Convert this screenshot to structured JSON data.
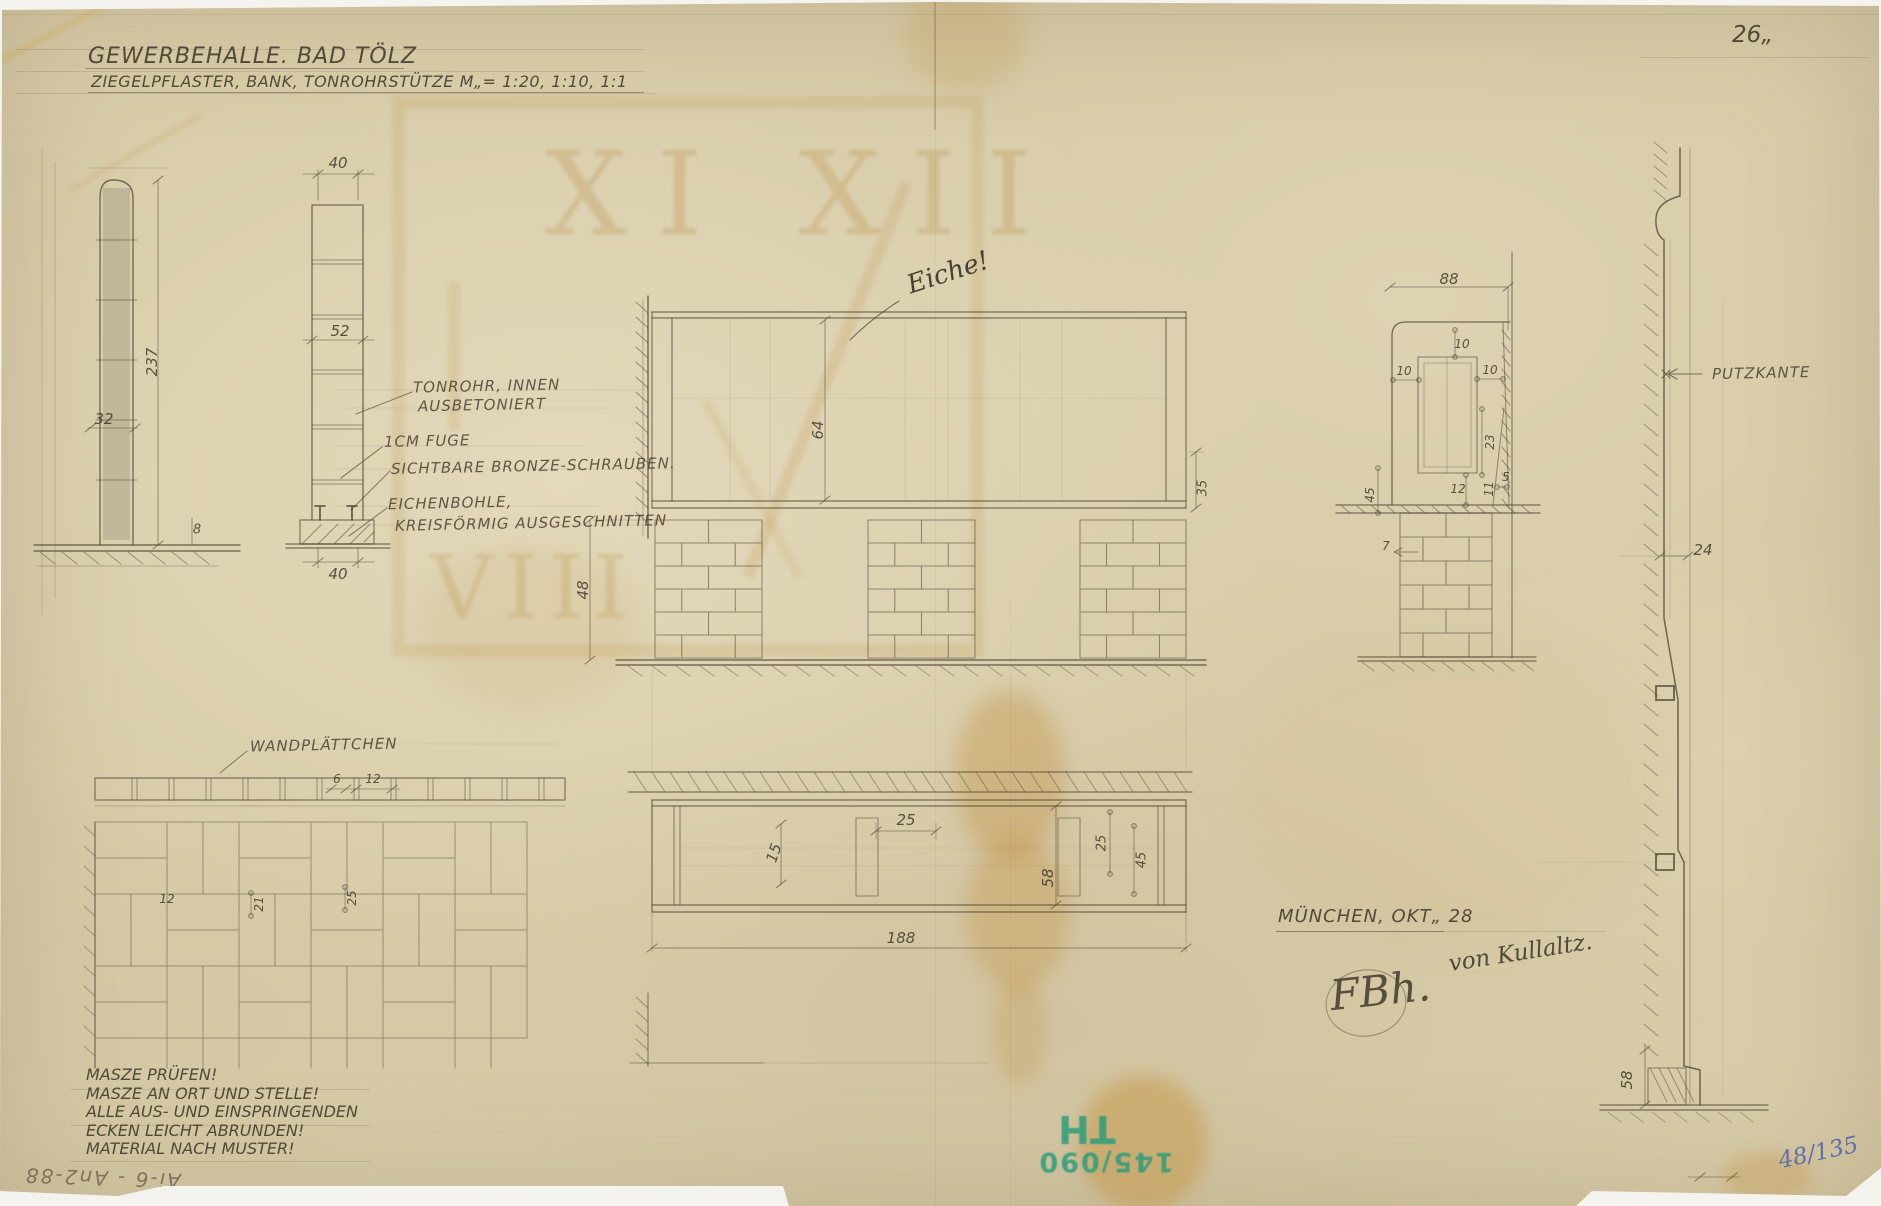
{
  "sheet": {
    "number": "26„",
    "inventory": "48/135",
    "reverse_note": "Ai-6 - An2-88"
  },
  "title": {
    "line1": "GEWERBEHALLE. BAD TÖLZ",
    "line2": "ZIEGELPFLASTER, BANK, TONROHRSTÜTZE M„= 1:20, 1:10, 1:1"
  },
  "notes": {
    "lines": [
      "MASZE PRÜFEN!",
      "MASZE AN ORT UND STELLE!",
      "ALLE AUS- UND EINSPRINGENDEN",
      "ECKEN LEICHT ABRUNDEN!",
      "MATERIAL NACH MUSTER!"
    ]
  },
  "credit": {
    "city_date": "MÜNCHEN, OKT„ 28",
    "signature": "von Kullaltz.",
    "monogram": "FBh.",
    "material_note": "Eiche!"
  },
  "stamp": {
    "letters": "TH",
    "number": "145/090",
    "color": "#2b9d7a"
  },
  "watermark": {
    "numerals_top": "XI XII",
    "numerals_bottom": "VIII"
  },
  "callouts": [
    {
      "text": "TONROHR, INNEN",
      "x": 413,
      "y": 377
    },
    {
      "text": "AUSBETONIERT",
      "x": 418,
      "y": 396
    },
    {
      "text": "1CM FUGE",
      "x": 384,
      "y": 432
    },
    {
      "text": "SICHTBARE BRONZE-SCHRAUBEN.",
      "x": 391,
      "y": 457
    },
    {
      "text": "EICHENBOHLE,",
      "x": 388,
      "y": 494
    },
    {
      "text": "KREISFÖRMIG AUSGESCHNITTEN",
      "x": 395,
      "y": 514
    },
    {
      "text": "WANDPLÄTTCHEN",
      "x": 250,
      "y": 736
    },
    {
      "text": "PUTZKANTE",
      "x": 1712,
      "y": 364
    }
  ],
  "dimensions": [
    {
      "text": "237",
      "x": 152,
      "y": 362,
      "rot": -90
    },
    {
      "text": "32",
      "x": 104,
      "y": 419
    },
    {
      "text": "8",
      "x": 197,
      "y": 530,
      "size": 13
    },
    {
      "text": "40",
      "x": 338,
      "y": 163
    },
    {
      "text": "52",
      "x": 340,
      "y": 331
    },
    {
      "text": "40",
      "x": 338,
      "y": 574
    },
    {
      "text": "64",
      "x": 818,
      "y": 430,
      "rot": -90
    },
    {
      "text": "48",
      "x": 583,
      "y": 590,
      "rot": -90
    },
    {
      "text": "35",
      "x": 1203,
      "y": 488,
      "rot": -90,
      "size": 13
    },
    {
      "text": "25",
      "x": 906,
      "y": 820
    },
    {
      "text": "15",
      "x": 774,
      "y": 853,
      "rot": -72
    },
    {
      "text": "25",
      "x": 1102,
      "y": 843,
      "rot": -90,
      "size": 13
    },
    {
      "text": "45",
      "x": 1142,
      "y": 860,
      "rot": -90,
      "size": 13
    },
    {
      "text": "58",
      "x": 1048,
      "y": 878,
      "rot": -90
    },
    {
      "text": "188",
      "x": 901,
      "y": 938
    },
    {
      "text": "6",
      "x": 337,
      "y": 779,
      "size": 12
    },
    {
      "text": "12",
      "x": 373,
      "y": 779,
      "size": 12
    },
    {
      "text": "12",
      "x": 167,
      "y": 899,
      "size": 12
    },
    {
      "text": "21",
      "x": 259,
      "y": 904,
      "rot": -90,
      "size": 12
    },
    {
      "text": "25",
      "x": 352,
      "y": 898,
      "rot": -90,
      "size": 12
    },
    {
      "text": "88",
      "x": 1449,
      "y": 279
    },
    {
      "text": "10",
      "x": 1462,
      "y": 344,
      "size": 12
    },
    {
      "text": "10",
      "x": 1404,
      "y": 371,
      "size": 12
    },
    {
      "text": "10",
      "x": 1490,
      "y": 370,
      "size": 12
    },
    {
      "text": "23",
      "x": 1490,
      "y": 442,
      "rot": -90,
      "size": 12
    },
    {
      "text": "12",
      "x": 1458,
      "y": 489,
      "size": 12
    },
    {
      "text": "11",
      "x": 1489,
      "y": 489,
      "rot": -90,
      "size": 12
    },
    {
      "text": "5",
      "x": 1506,
      "y": 477,
      "size": 12
    },
    {
      "text": "45",
      "x": 1370,
      "y": 495,
      "rot": -90,
      "size": 12
    },
    {
      "text": "7",
      "x": 1386,
      "y": 546,
      "size": 12
    },
    {
      "text": "24",
      "x": 1703,
      "y": 550
    },
    {
      "text": "58",
      "x": 1627,
      "y": 1080,
      "rot": -90
    }
  ]
}
